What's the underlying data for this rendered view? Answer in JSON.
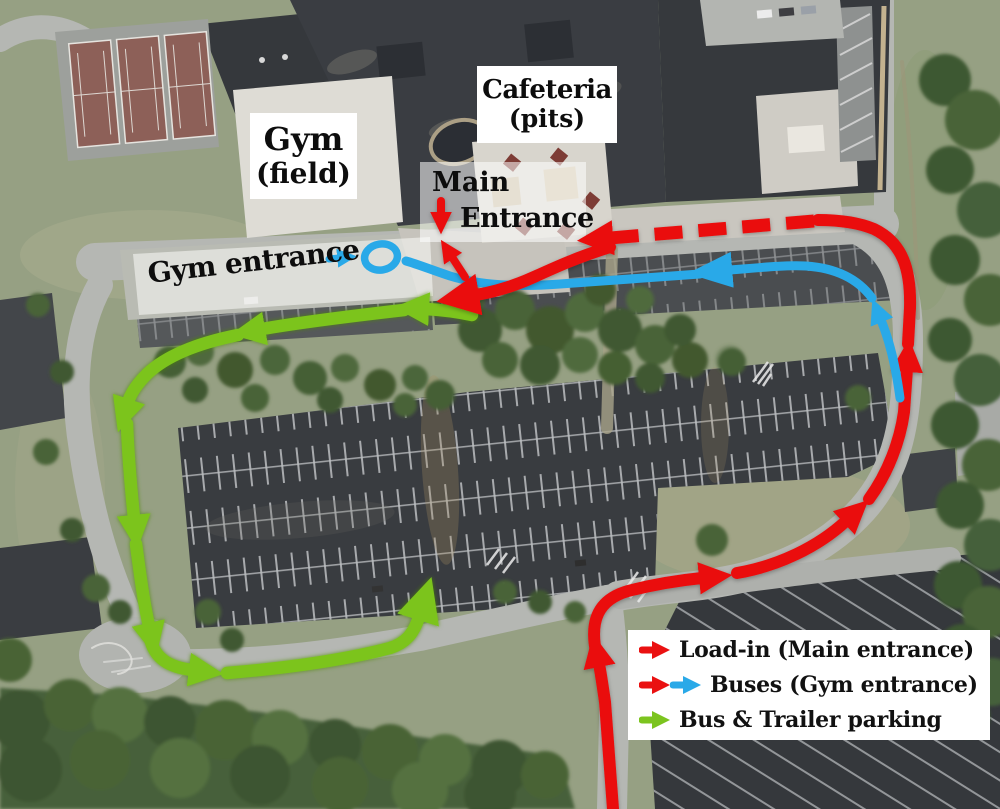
{
  "colors": {
    "route_red": "#ea1111",
    "route_blue": "#29a9e8",
    "route_green": "#7cc41f"
  },
  "map_labels": {
    "gym": {
      "line1": "Gym",
      "line2": "(field)"
    },
    "cafeteria": {
      "line1": "Cafeteria",
      "line2": "(pits)"
    },
    "main_entrance": {
      "line1": "Main",
      "line2": "Entrance"
    },
    "gym_entrance": "Gym entrance"
  },
  "legend": {
    "items": [
      {
        "label": "Load-in (Main entrance)",
        "arrows": [
          "red"
        ]
      },
      {
        "label": "Buses (Gym entrance)",
        "arrows": [
          "red",
          "blue"
        ]
      },
      {
        "label": "Bus & Trailer parking",
        "arrows": [
          "green"
        ]
      }
    ]
  }
}
